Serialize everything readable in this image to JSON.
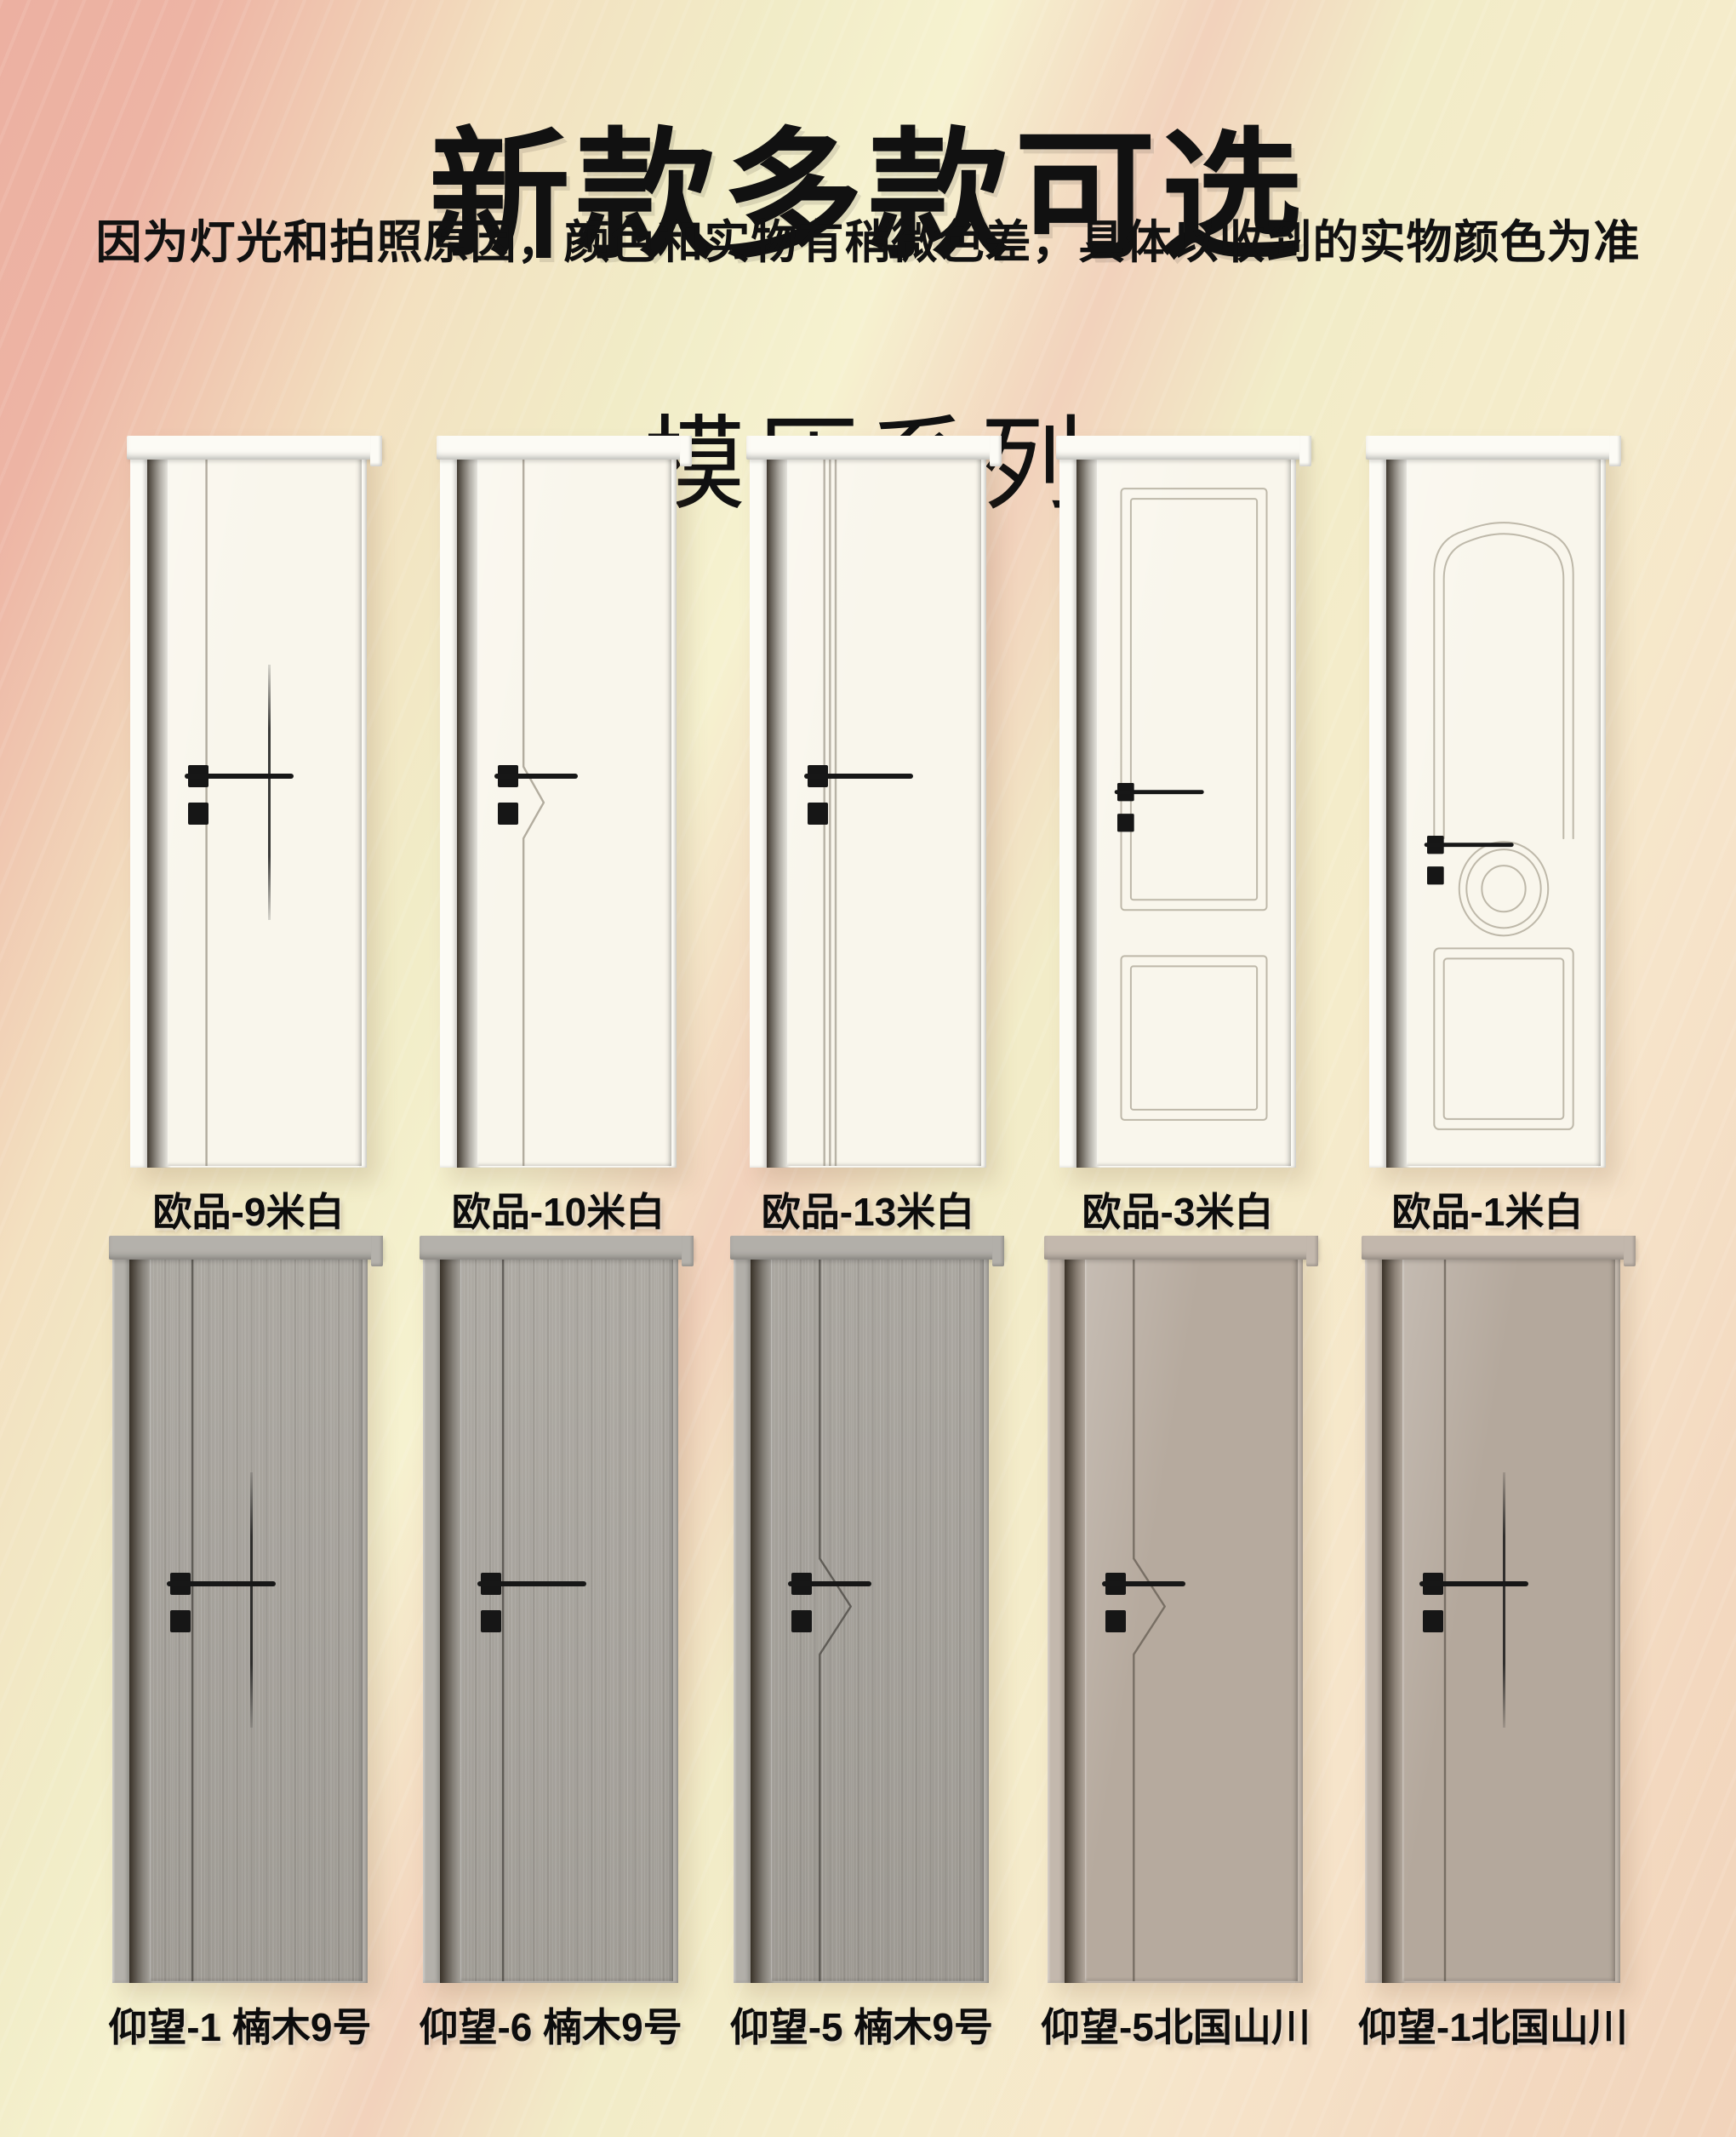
{
  "poster": {
    "title": "新款多款可选",
    "subtitle": "因为灯光和拍照原因，颜色和实物有稍微色差，具体以收到的实物颜色为准",
    "series_title": "模压系列"
  },
  "palette": {
    "background_pink": "#ecb0a1",
    "background_cream": "#f2eec9",
    "background_peach": "#f3d9c0",
    "text_color": "#111111",
    "handle_color": "#1a1a1a",
    "white_door": "#f9f6ec",
    "gray_wood_door": "#a7a39c",
    "taupe_door": "#b5a99d"
  },
  "doors": [
    {
      "label": "欧品-9米白",
      "design": "groove-cross",
      "material": "smooth",
      "leaf_color": "#f9f6ec",
      "frame_color": "#fcfbf5",
      "line_color": "rgba(120,112,95,0.55)"
    },
    {
      "label": "欧品-10米白",
      "design": "groove-chevron-small",
      "material": "smooth",
      "leaf_color": "#f9f6ec",
      "frame_color": "#fcfbf5",
      "line_color": "rgba(120,112,95,0.55)"
    },
    {
      "label": "欧品-13米白",
      "design": "channel",
      "material": "smooth",
      "leaf_color": "#f9f6ec",
      "frame_color": "#fcfbf5",
      "line_color": "rgba(120,112,95,0.50)"
    },
    {
      "label": "欧品-3米白",
      "design": "two-panel",
      "material": "smooth",
      "leaf_color": "#f9f6ec",
      "frame_color": "#fcfbf5",
      "line_color": "rgba(150,143,125,0.60)"
    },
    {
      "label": "欧品-1米白",
      "design": "euro-arch",
      "material": "smooth",
      "leaf_color": "#f9f6ec",
      "frame_color": "#fcfbf5",
      "line_color": "rgba(150,143,125,0.60)"
    },
    {
      "label": "仰望-1 楠木9号",
      "design": "groove-cross",
      "material": "wood",
      "leaf_color": "#a7a39c",
      "frame_color": "#b4b1ab",
      "line_color": "rgba(50,47,42,0.60)"
    },
    {
      "label": "仰望-6 楠木9号",
      "design": "groove-bar",
      "material": "wood",
      "leaf_color": "#a9a59e",
      "frame_color": "#b4b1ab",
      "line_color": "rgba(50,47,42,0.60)"
    },
    {
      "label": "仰望-5 楠木9号",
      "design": "groove-chevron",
      "material": "wood",
      "leaf_color": "#a5a19a",
      "frame_color": "#b2afa9",
      "line_color": "rgba(50,47,42,0.60)"
    },
    {
      "label": "仰望-5北国山川",
      "design": "groove-chevron",
      "material": "smooth",
      "leaf_color": "#b6aa9e",
      "frame_color": "#c3b8ad",
      "line_color": "rgba(70,62,52,0.55)"
    },
    {
      "label": "仰望-1北国山川",
      "design": "groove-cross",
      "material": "smooth",
      "leaf_color": "#b4a89c",
      "frame_color": "#c2b7ac",
      "line_color": "rgba(70,62,52,0.55)"
    }
  ]
}
